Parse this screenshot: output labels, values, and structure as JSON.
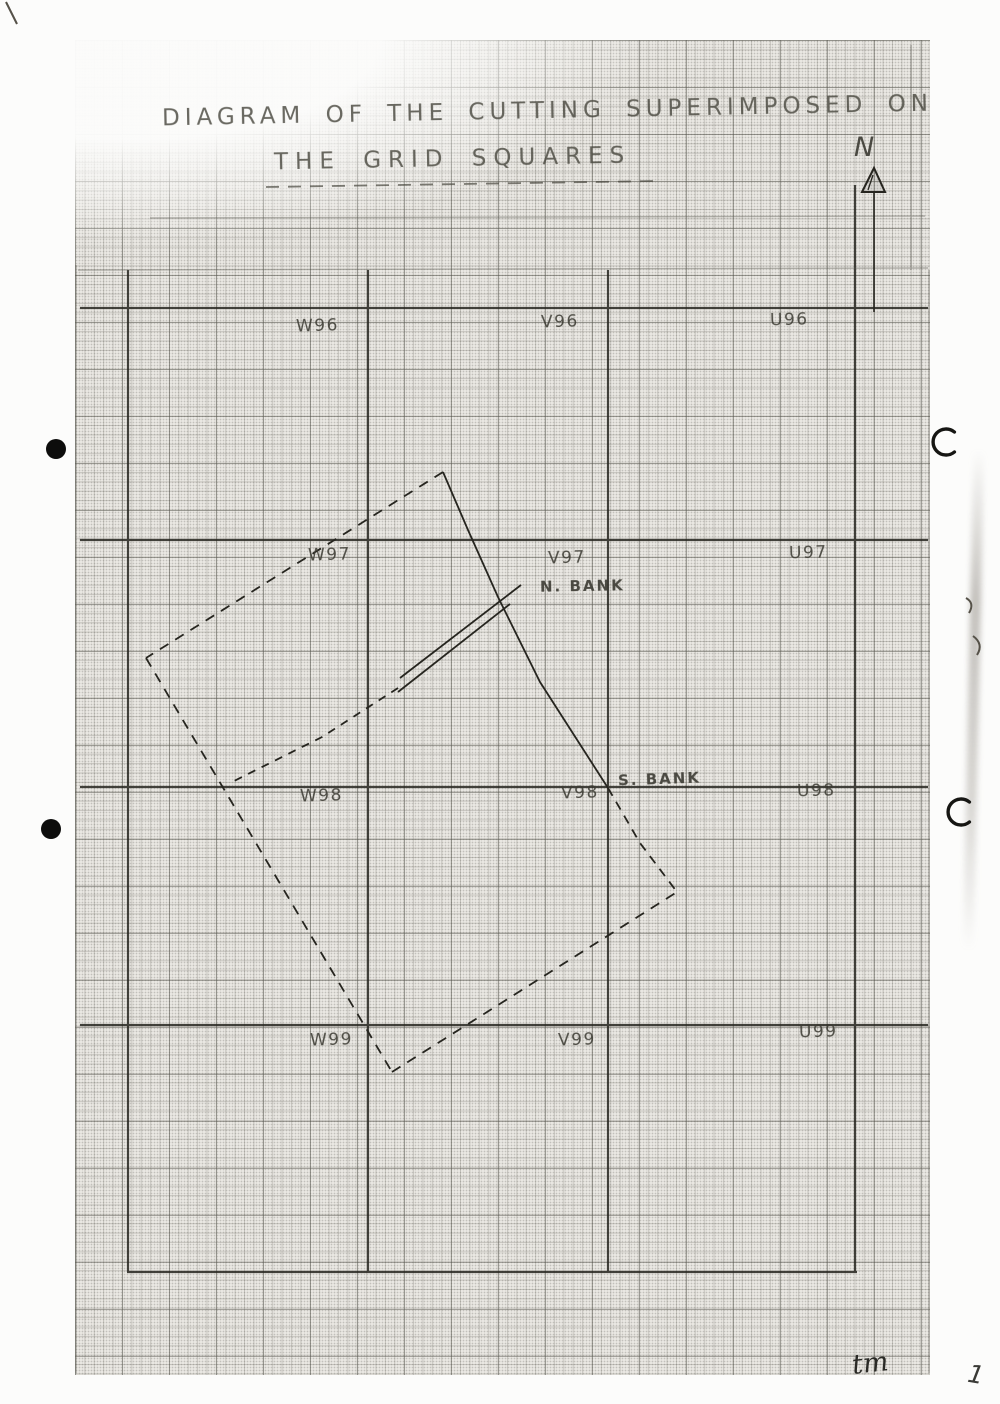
{
  "page": {
    "title_line1": "DIAGRAM OF THE CUTTING SUPERIMPOSED ON",
    "title_line2": "THE GRID SQUARES",
    "north_label": "N",
    "initials": "tm",
    "page_number": "1"
  },
  "grid_labels": {
    "w96": "W96",
    "v96": "V96",
    "u96": "U96",
    "w97": "W97",
    "v97": "V97",
    "u97": "U97",
    "w98": "W98",
    "v98": "V98",
    "u98": "U98",
    "w99": "W99",
    "v99": "V99",
    "u99": "U99"
  },
  "annotations": {
    "n_bank": "N. BANK",
    "s_bank": "S. BANK"
  },
  "cutting": {
    "nw_edge_points": "443,472 146,658",
    "sw_edge_points": "146,658 392,1072",
    "se_edge_points": "392,1072 677,892",
    "east_edge_solid_points": "443,472 468,530 498,597 540,682 608,788",
    "east_edge_dashed_points": "608,788 640,843 677,892",
    "north_bank_points": "521,585 400,678",
    "south_bank_points": "510,604 398,692",
    "bank_ext_points": "398,688 322,737 230,783"
  },
  "colors": {
    "ink": "#26251f",
    "paper": "#e9e7e2",
    "grid_line": "#8f8d85"
  }
}
